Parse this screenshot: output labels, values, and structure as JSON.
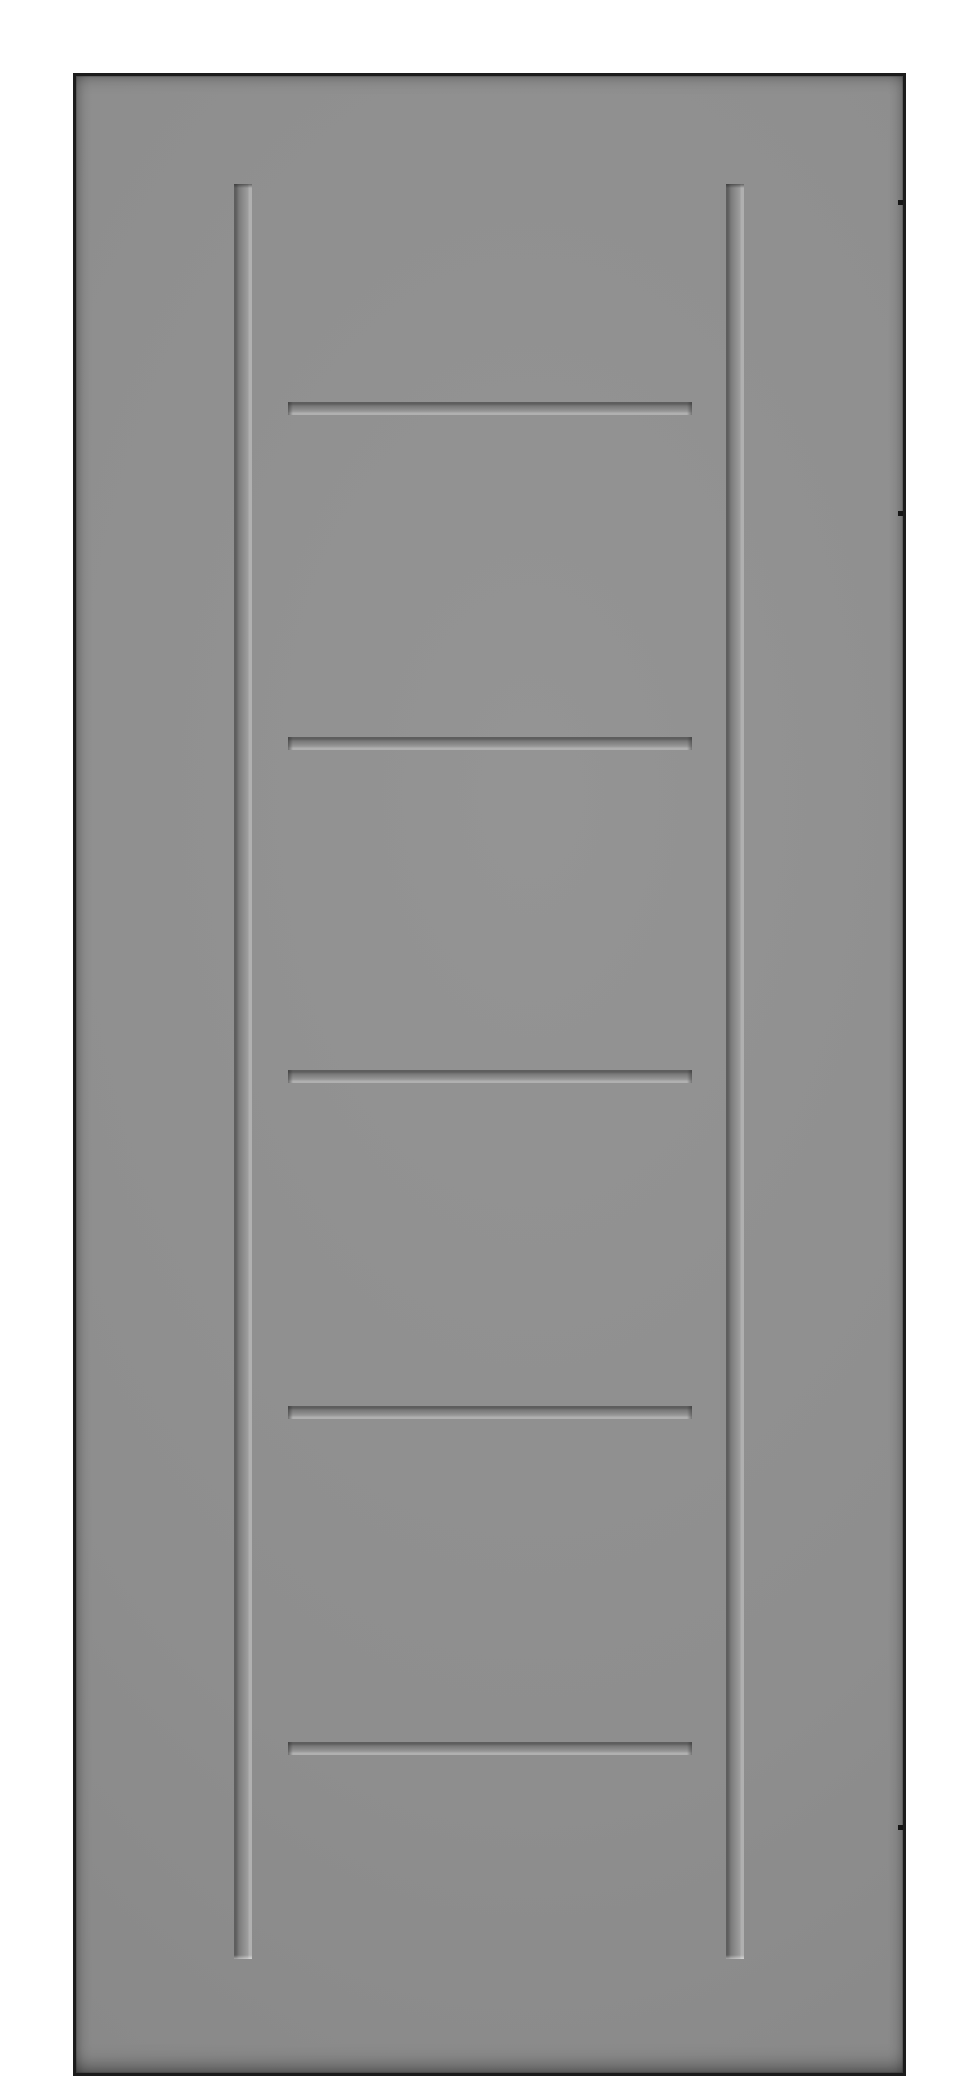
{
  "meta": {
    "description": "Product image of a grey five-panel shaker style interior door slab, shown upright on a plain white background. No text is visible in the image.",
    "object": "interior-door-slab",
    "panel_count": 5
  },
  "colors": {
    "bg": "#ffffff",
    "face_center": "#949494",
    "face_mid": "#8e8e8e",
    "face_edge": "#848484",
    "edge_line": "#1c1c1c",
    "groove_shadow": "#5e5e5e",
    "groove_recess": "#8f8f8f",
    "groove_highlight": "#b0b0b0",
    "hinge_mark": "#161616"
  },
  "door": {
    "x": 73,
    "y": 73,
    "width": 833,
    "height": 2003,
    "border_px": 3
  },
  "grooves": {
    "vertical": [
      {
        "name": "vertical-groove-left",
        "left": 158,
        "top": 108,
        "width": 18,
        "height": 1775
      },
      {
        "name": "vertical-groove-right",
        "left": 650,
        "top": 108,
        "width": 18,
        "height": 1775
      }
    ],
    "horizontal": [
      {
        "name": "horizontal-groove-1",
        "left": 212,
        "top": 326,
        "width": 404,
        "height": 13
      },
      {
        "name": "horizontal-groove-2",
        "left": 212,
        "top": 661,
        "width": 404,
        "height": 13
      },
      {
        "name": "horizontal-groove-3",
        "left": 212,
        "top": 994,
        "width": 404,
        "height": 13
      },
      {
        "name": "horizontal-groove-4",
        "left": 212,
        "top": 1330,
        "width": 404,
        "height": 13
      },
      {
        "name": "horizontal-groove-5",
        "left": 212,
        "top": 1666,
        "width": 404,
        "height": 13
      }
    ]
  },
  "hinge_marks": {
    "size": 5,
    "items": [
      {
        "name": "hinge-mark-top",
        "left": 822,
        "top": 124
      },
      {
        "name": "hinge-mark-upper",
        "left": 822,
        "top": 435
      },
      {
        "name": "hinge-mark-bottom",
        "left": 822,
        "top": 1749
      }
    ]
  }
}
